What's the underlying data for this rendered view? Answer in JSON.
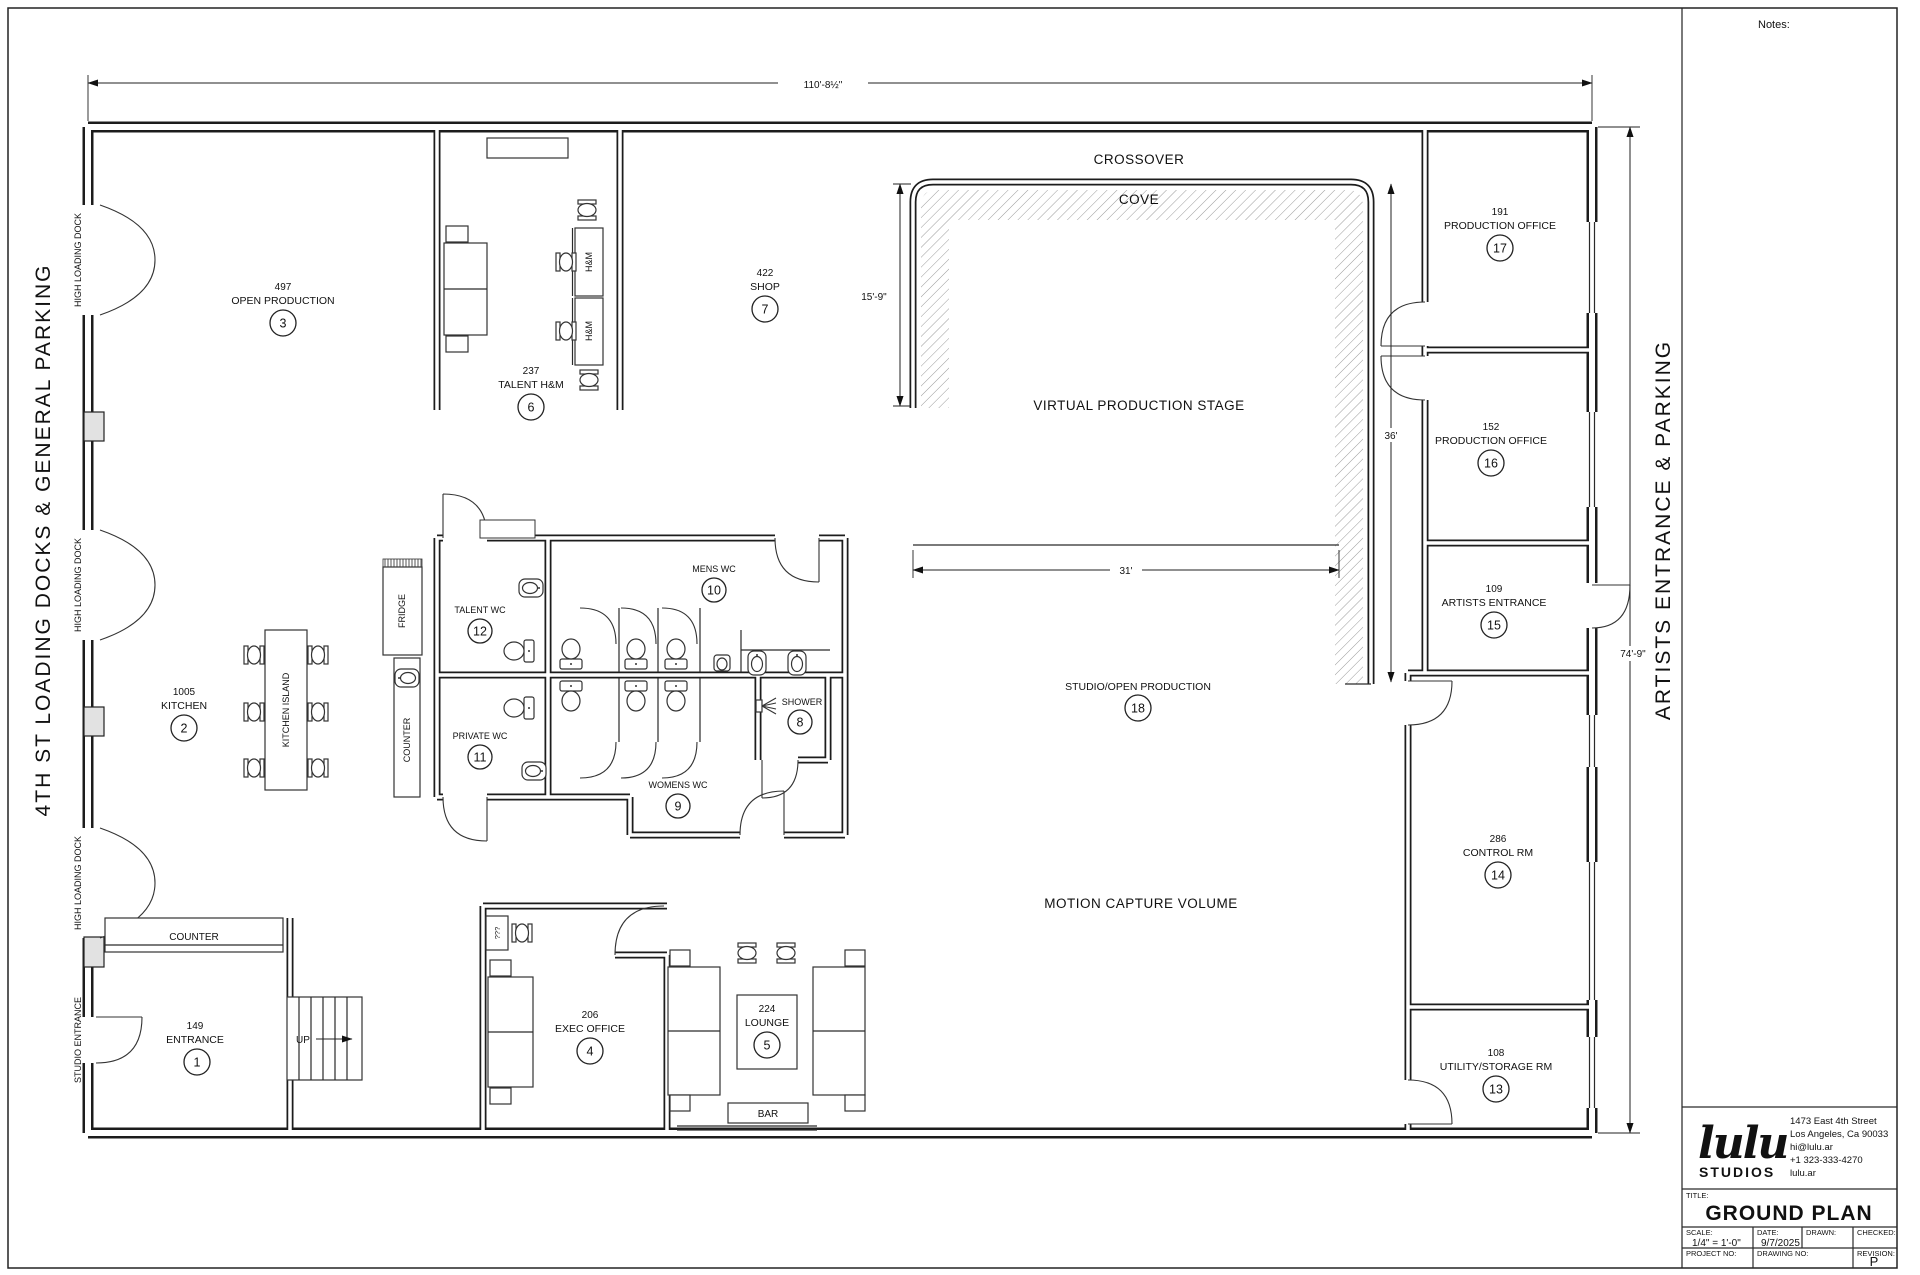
{
  "sheet": {
    "notes_label": "Notes:",
    "side_left": "4TH ST LOADING DOCKS & GENERAL PARKING",
    "side_right": "ARTISTS ENTRANCE & PARKING",
    "title_block": {
      "logo_script": "lulu",
      "logo_sub": "STUDIOS",
      "address": [
        "1473 East 4th Street",
        "Los Angeles, Ca 90033",
        "hi@lulu.ar",
        "+1 323-333-4270",
        "lulu.ar"
      ],
      "title_label": "TITLE:",
      "title": "GROUND PLAN",
      "scale_label": "SCALE:",
      "scale_value": "1/4\" = 1'-0\"",
      "date_label": "DATE:",
      "date_value": "9/7/2025",
      "drawn_label": "DRAWN:",
      "checked_label": "CHECKED:",
      "project_label": "PROJECT NO:",
      "drawing_label": "DRAWING NO:",
      "revision_label": "REVISION:",
      "revision_value": "P"
    }
  },
  "plan": {
    "dims": {
      "top": "110'-8½\"",
      "right": "74'-9\"",
      "cove_height": "15'-9\"",
      "stage_depth": "36'",
      "stage_width": "31'"
    },
    "zones": {
      "crossover": "CROSSOVER",
      "cove": "COVE",
      "stage": "VIRTUAL PRODUCTION STAGE",
      "studio_name": "STUDIO/OPEN PRODUCTION",
      "studio_num": "18",
      "mocap": "MOTION CAPTURE VOLUME"
    },
    "wall_labels": {
      "dock": "HIGH LOADING DOCK",
      "studio_entrance": "STUDIO ENTRANCE"
    },
    "furniture": {
      "counter": "COUNTER",
      "kitchen_island": "KITCHEN ISLAND",
      "fridge": "FRIDGE",
      "counter2": "COUNTER",
      "hm": "H&M",
      "bar": "BAR",
      "up": "UP",
      "desk": "???"
    },
    "rooms": [
      {
        "area": "149",
        "name": "ENTRANCE",
        "num": "1"
      },
      {
        "area": "1005",
        "name": "KITCHEN",
        "num": "2"
      },
      {
        "area": "497",
        "name": "OPEN PRODUCTION",
        "num": "3"
      },
      {
        "area": "206",
        "name": "EXEC OFFICE",
        "num": "4"
      },
      {
        "area": "224",
        "name": "LOUNGE",
        "num": "5"
      },
      {
        "area": "237",
        "name": "TALENT H&M",
        "num": "6"
      },
      {
        "area": "422",
        "name": "SHOP",
        "num": "7"
      },
      {
        "area": "",
        "name": "SHOWER",
        "num": "8"
      },
      {
        "area": "",
        "name": "WOMENS WC",
        "num": "9"
      },
      {
        "area": "",
        "name": "MENS WC",
        "num": "10"
      },
      {
        "area": "",
        "name": "PRIVATE WC",
        "num": "11"
      },
      {
        "area": "",
        "name": "TALENT WC",
        "num": "12"
      },
      {
        "area": "108",
        "name": "UTILITY/STORAGE RM",
        "num": "13"
      },
      {
        "area": "286",
        "name": "CONTROL RM",
        "num": "14"
      },
      {
        "area": "109",
        "name": "ARTISTS ENTRANCE",
        "num": "15"
      },
      {
        "area": "152",
        "name": "PRODUCTION OFFICE",
        "num": "16"
      },
      {
        "area": "191",
        "name": "PRODUCTION OFFICE",
        "num": "17"
      }
    ]
  }
}
